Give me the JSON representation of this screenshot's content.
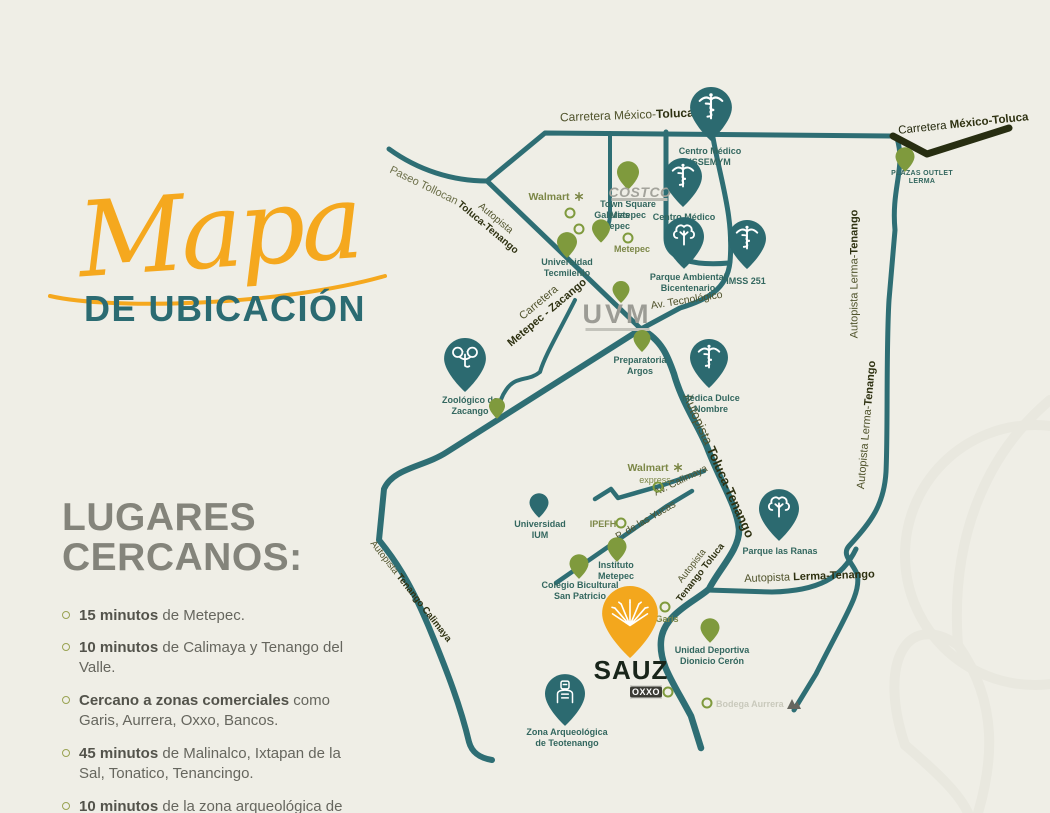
{
  "colors": {
    "background": "#efeee6",
    "road_teal": "#2e6e74",
    "road_dark": "#272d11",
    "pin_teal": "#2c6a70",
    "pin_green": "#7f9a3d",
    "accent_orange": "#f3a71d",
    "title_teal": "#2b6b72",
    "heading_gray": "#84847b",
    "label_olive": "#50532c",
    "label_teal": "#33675f"
  },
  "title": {
    "script": "Mapa",
    "subtitle": "DE UBICACIÓN"
  },
  "nearby": {
    "heading_line1": "LUGARES",
    "heading_line2": "CERCANOS:",
    "items": [
      {
        "bold": "15 minutos",
        "rest": " de Metepec."
      },
      {
        "bold": "10 minutos",
        "rest": " de Calimaya y Tenango del Valle."
      },
      {
        "bold": "Cercano a zonas comerciales",
        "rest": " como Garis, Aurrera, Oxxo, Bancos."
      },
      {
        "bold": "45 minutos",
        "rest": " de Malinalco, Ixtapan de la Sal, Tonatico, Tenancingo."
      },
      {
        "bold": "10 minutos",
        "rest": " de la zona arqueológica de Teotenango."
      }
    ]
  },
  "roads": {
    "carretera_mexico_toluca_center": {
      "regular": "Carretera México-",
      "bold": "Toluca"
    },
    "carretera_mexico_toluca_right": {
      "regular": "Carretera ",
      "bold": "México-Toluca"
    },
    "paseo_tollocan": {
      "text": "Paseo Tollocan"
    },
    "autopista_toluca_tenango_nw": {
      "line1": "Autopista",
      "line2": "Toluca-Tenango"
    },
    "carretera_metepec_zacango": {
      "line1": "Carretera",
      "line2": "Metepec - Zacango"
    },
    "av_tecnologico": {
      "text": "Av. Tecnológico"
    },
    "autopista_lerma_tenango_vertical": {
      "regular": "Autopista Lerma-",
      "bold": "Tenango"
    },
    "autopista_toluca_tenango_big": {
      "regular": "Autopista ",
      "bold": "Toluca-Tenango"
    },
    "av_calimaya": {
      "text": "Av. Calimaya"
    },
    "p_de_las_yucas": {
      "text": "P. de las Yucas"
    },
    "autopista_tenango_toluca": {
      "line1": "Autopista",
      "line2": "Tenango Toluca"
    },
    "autopista_lerma_tenango_horizontal": {
      "regular": "Autopista ",
      "bold": "Lerma-Tenango"
    },
    "autopista_tenango_calimaya": {
      "regular": "Autopista ",
      "bold": "Tenango Calimaya"
    }
  },
  "pois": {
    "centro_medico_issemym": {
      "line1": "Centro Médico",
      "line2": "ISSEMYM"
    },
    "town_square_metepec": {
      "line1": "Town Square",
      "line2": "Metepec"
    },
    "walmart": {
      "name": "Walmart"
    },
    "costco": {
      "name": "COSTCO"
    },
    "galerias_metepec": {
      "line1": "Galerias",
      "line2": "Metepec"
    },
    "centro_medico_toluca": {
      "line1": "Centro Médico",
      "line2": "Toluca"
    },
    "metepec": {
      "name": "Metepec"
    },
    "universidad_tecmilenio": {
      "line1": "Universidad",
      "line2": "Tecmilenio"
    },
    "parque_ambiental_bicentenario": {
      "line1": "Parque Ambiental",
      "line2": "Bicentenario"
    },
    "imss_251": {
      "name": "IMSS 251"
    },
    "uvm": {
      "name": "UVM"
    },
    "preparatoria_argos": {
      "line1": "Preparatoria",
      "line2": "Argos"
    },
    "medica_dulce_nombre": {
      "line1": "Médica Dulce",
      "line2": "Nombre"
    },
    "zoologico_zacango": {
      "line1": "Zoológico de",
      "line2": "Zacango"
    },
    "plazas_outlet_lerma": {
      "line1": "PLAZAS OUTLET",
      "line2": "LERMA"
    },
    "walmart_express": {
      "line1": "Walmart",
      "line2": "express"
    },
    "ipefh": {
      "name": "IPEFH"
    },
    "universidad_ium": {
      "line1": "Universidad",
      "line2": "IUM"
    },
    "instituto_metepec": {
      "line1": "Instituto",
      "line2": "Metepec"
    },
    "colegio_bicultural_san_patricio": {
      "line1": "Colegio Bicultural",
      "line2": "San Patricio"
    },
    "parque_las_ranas": {
      "name": "Parque las Ranas"
    },
    "garis": {
      "name": "Garis"
    },
    "sauz": {
      "name": "SAUZ"
    },
    "oxxo": {
      "name": "OXXO"
    },
    "unidad_deportiva_dionicio_ceron": {
      "line1": "Unidad Deportiva",
      "line2": "Dionicio Cerón"
    },
    "bodega_aurrera": {
      "name": "Bodega Aurrera"
    },
    "zona_arqueologica_teotenango": {
      "line1": "Zona Arqueológica",
      "line2": "de Teotenango"
    }
  }
}
